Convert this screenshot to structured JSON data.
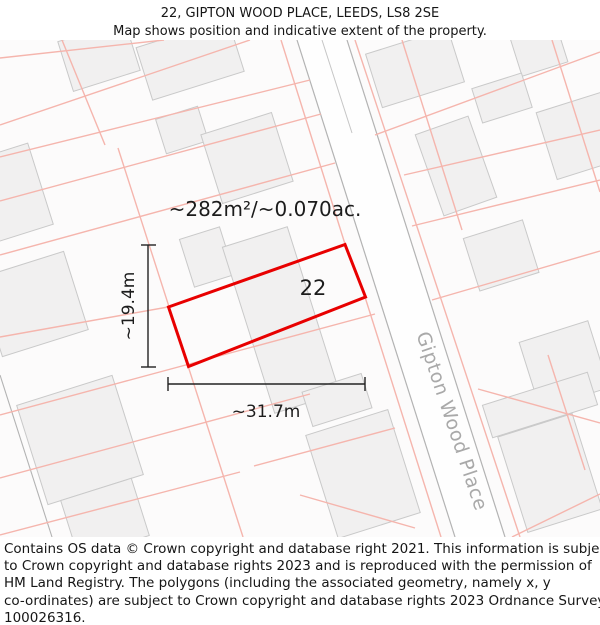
{
  "title": {
    "line1": "22, GIPTON WOOD PLACE, LEEDS, LS8 2SE",
    "line2": "Map shows position and indicative extent of the property."
  },
  "map": {
    "area_label": "~282m²/~0.070ac.",
    "plot_number": "22",
    "width_label": "~31.7m",
    "height_label": "~19.4m",
    "street_label": "Gipton Wood Place",
    "colors": {
      "plot_outline": "#e80000",
      "parcel_line": "#f5b5ad",
      "building_fill": "#f1f0f0",
      "building_stroke": "#c9c9c9",
      "road_edge": "#b3b3b3",
      "street_text": "#a9a9a9",
      "annotation": "#161616"
    }
  },
  "footer": {
    "lines": [
      "Contains OS data © Crown copyright and database right 2021. This information is subject",
      "to Crown copyright and database rights 2023 and is reproduced with the permission of",
      "HM Land Registry. The polygons (including the associated geometry, namely x, y",
      "co-ordinates) are subject to Crown copyright and database rights 2023 Ordnance Survey",
      "100026316."
    ]
  }
}
